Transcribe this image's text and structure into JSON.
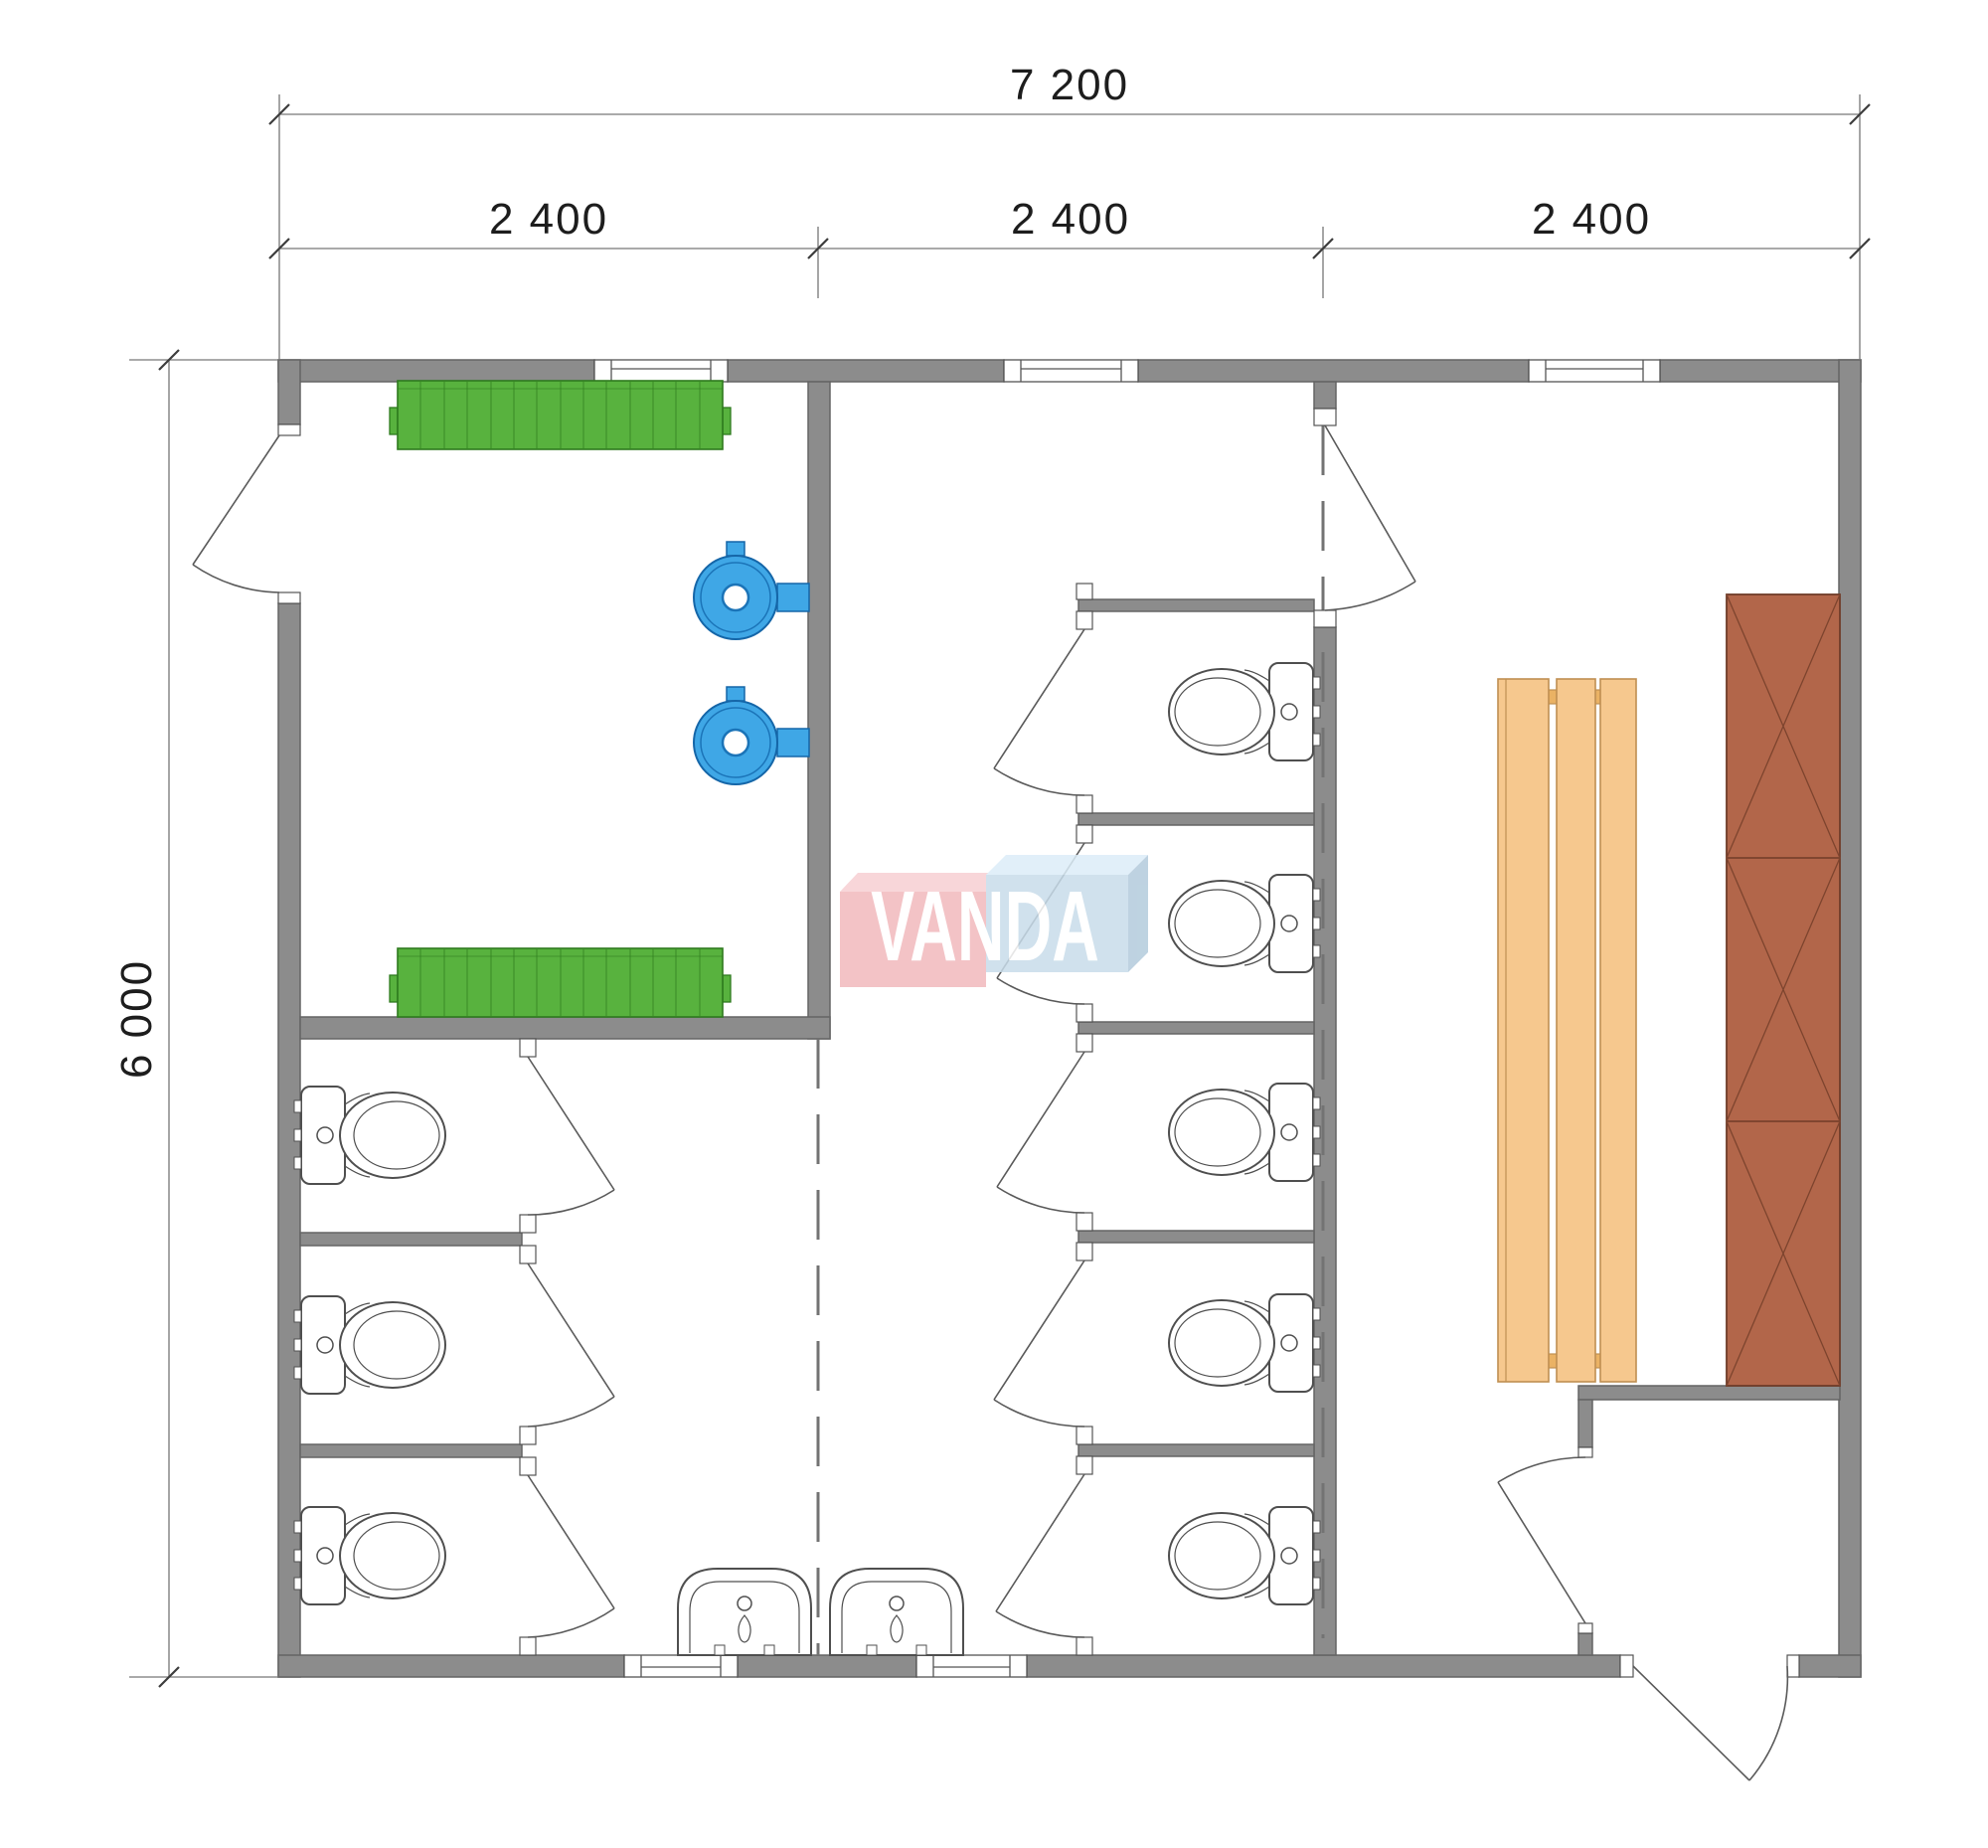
{
  "watermark": {
    "text": "VANDA"
  },
  "dimensions": {
    "overall_width_label": "7 200",
    "module_labels": [
      "2 400",
      "2 400",
      "2 400"
    ],
    "overall_height_label": "6 000"
  },
  "palette": {
    "wall_fill": "#8c8c8c",
    "wall_edge": "#656565",
    "radiator_green": "#58b23e",
    "water_heater_blue": "#3fa7e6",
    "bench_tan": "#f6c88e",
    "locker_brown": "#b2664a",
    "logo_band_pink": "#f2b9bd",
    "logo_box_blue": "#c8dcea",
    "dashed_grid": "#737373"
  },
  "fixtures": {
    "toilets": 8,
    "sinks": 2,
    "radiators": 2,
    "water_heaters": 2,
    "bench_slats": 3,
    "locker_sections": 3,
    "windows": 5,
    "doors": 12
  }
}
